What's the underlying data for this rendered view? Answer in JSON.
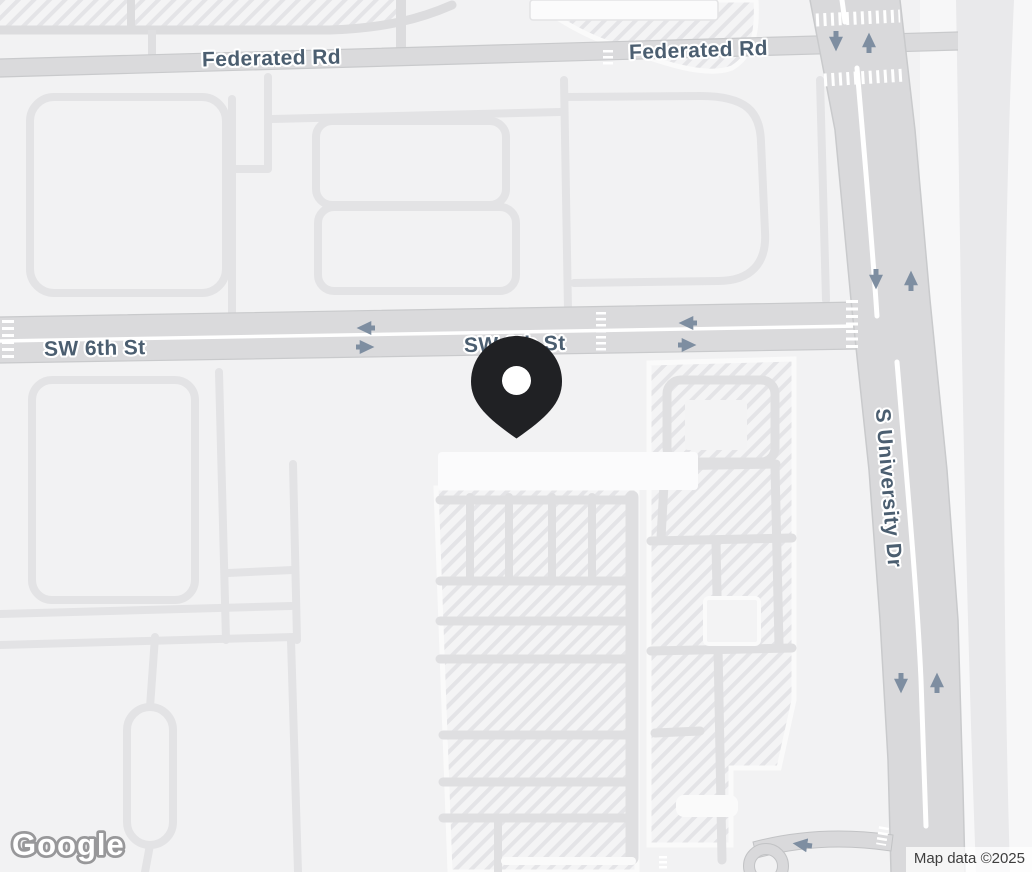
{
  "map": {
    "view": "road",
    "labels": {
      "federated_rd": "Federated Rd",
      "sw_6th_st": "SW 6th St",
      "s_university_dr": "S University Dr"
    },
    "marker": {
      "name": "location-pin",
      "color": "#202124",
      "near": "SW 6th St"
    },
    "one_way_arrows": {
      "s_university_dr": [
        "down",
        "up",
        "down",
        "up",
        "down",
        "up"
      ],
      "sw_6th_st": [
        "left",
        "right",
        "left",
        "right"
      ],
      "side_street": [
        "left"
      ]
    },
    "attribution": {
      "logo": "Google",
      "map_data": "Map data ©2025"
    },
    "colors": {
      "background": "#f2f2f3",
      "road_fill": "#dadadc",
      "road_casing": "#c9cacc",
      "minor_road": "#e3e3e5",
      "parking_hatch": "#e4e4e7",
      "label_text": "#4b5e70",
      "arrow": "#7e8ea1",
      "marker": "#202124"
    }
  }
}
